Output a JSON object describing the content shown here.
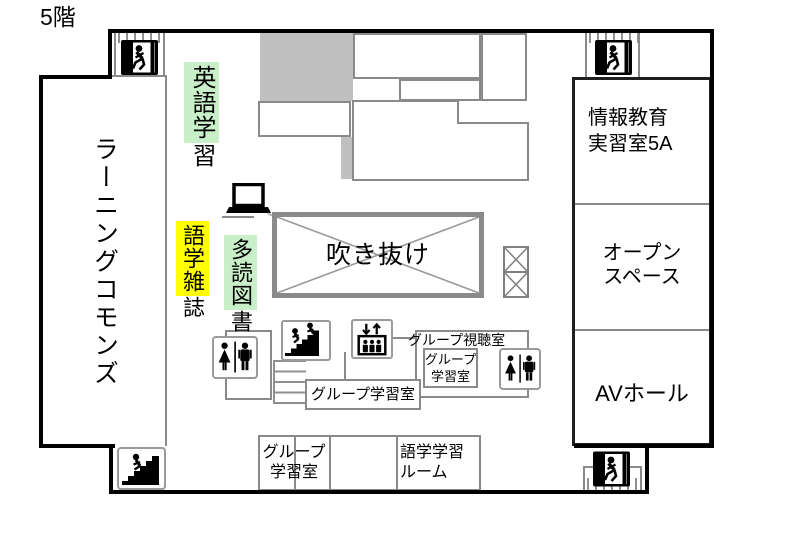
{
  "floor_label": "5階",
  "colors": {
    "wall": "#000000",
    "partition": "#8a8a8a",
    "gray_fill": "#c0c0c0",
    "atrium_border": "#8a8a8a",
    "highlight_green": "#c9efc9",
    "highlight_yellow": "#ffff00"
  },
  "labels": {
    "learning_commons": "ラーニングコモンズ",
    "atrium": "吹き抜け",
    "info_room_line1": "情報教育",
    "info_room_line2": "実習室5A",
    "open_space_line1": "オープン",
    "open_space_line2": "スペース",
    "av_hall": "AVホール",
    "group_av_room": "グループ視聴室",
    "group_study_inner_line1": "グループ",
    "group_study_inner_line2": "学習室",
    "group_study_mid": "グループ学習室",
    "group_study_bottom_line1": "グループ",
    "group_study_bottom_line2": "学習室",
    "language_room_line1": "語学学習",
    "language_room_line2": "ルーム"
  },
  "shelf_labels": {
    "english_learning": {
      "highlighted": "英語学",
      "rest": "習"
    },
    "language_magazines": {
      "highlighted": "語学雑",
      "rest": "誌"
    },
    "tadoku_books": {
      "highlighted": "多読図",
      "rest": "書"
    }
  },
  "icons": {
    "emergency_exit": "emergency-exit-icon",
    "stairs_up": "stairs-up-icon",
    "stairs_people": "stairs-people-icon",
    "elevator": "elevator-icon",
    "restroom": "restroom-icon",
    "laptop": "laptop-icon",
    "elevator_shaft": "elevator-shaft-symbol",
    "atrium_cross": "atrium-cross-mark"
  }
}
